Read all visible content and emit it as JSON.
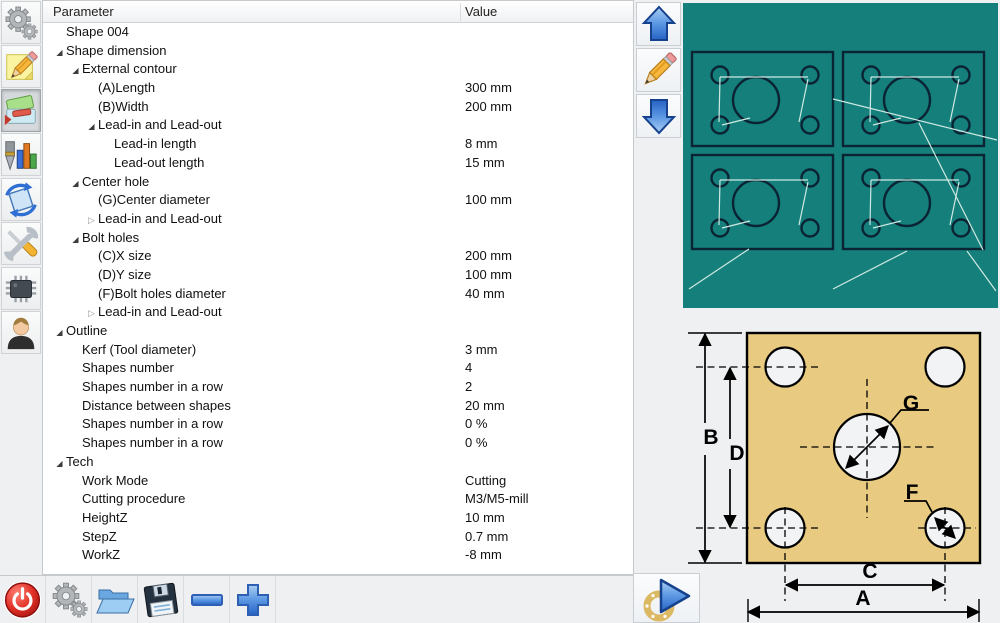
{
  "window": {
    "background": "#eef0f1",
    "accent_teal": "#15807b",
    "shape_outline_color": "#0a2434",
    "toolpath_color": "#cfe8e2",
    "plate_color": "#e8cb80"
  },
  "sidebar": {
    "items": [
      {
        "id": "settings",
        "icon": "gears-icon",
        "selected": false
      },
      {
        "id": "notes",
        "icon": "note-pencil-icon",
        "selected": false
      },
      {
        "id": "material",
        "icon": "material-icon",
        "selected": true
      },
      {
        "id": "tool-stats",
        "icon": "drill-chart-icon",
        "selected": false
      },
      {
        "id": "rotate",
        "icon": "rotate-icon",
        "selected": false
      },
      {
        "id": "tools",
        "icon": "wrench-screwdriver-icon",
        "selected": false
      },
      {
        "id": "hardware",
        "icon": "chip-icon",
        "selected": false
      },
      {
        "id": "user",
        "icon": "user-icon",
        "selected": false
      }
    ]
  },
  "table": {
    "columns": [
      "Parameter",
      "Value"
    ],
    "rows": [
      {
        "level": 0,
        "state": "none",
        "label": "Shape 004",
        "value": ""
      },
      {
        "level": 0,
        "state": "expanded",
        "label": "Shape dimension",
        "value": ""
      },
      {
        "level": 1,
        "state": "expanded",
        "label": "External contour",
        "value": ""
      },
      {
        "level": 2,
        "state": "none",
        "label": "(A)Length",
        "value": "300 mm"
      },
      {
        "level": 2,
        "state": "none",
        "label": "(B)Width",
        "value": "200 mm"
      },
      {
        "level": 2,
        "state": "expanded",
        "label": "Lead-in and Lead-out",
        "value": ""
      },
      {
        "level": 3,
        "state": "none",
        "label": "Lead-in length",
        "value": "8 mm"
      },
      {
        "level": 3,
        "state": "none",
        "label": "Lead-out length",
        "value": "15 mm"
      },
      {
        "level": 1,
        "state": "expanded",
        "label": "Center hole",
        "value": ""
      },
      {
        "level": 2,
        "state": "none",
        "label": "(G)Center diameter",
        "value": "100 mm"
      },
      {
        "level": 2,
        "state": "collapsed",
        "label": "Lead-in and Lead-out",
        "value": ""
      },
      {
        "level": 1,
        "state": "expanded",
        "label": "Bolt holes",
        "value": ""
      },
      {
        "level": 2,
        "state": "none",
        "label": "(C)X size",
        "value": "200 mm"
      },
      {
        "level": 2,
        "state": "none",
        "label": "(D)Y size",
        "value": "100 mm"
      },
      {
        "level": 2,
        "state": "none",
        "label": "(F)Bolt holes diameter",
        "value": "40 mm"
      },
      {
        "level": 2,
        "state": "collapsed",
        "label": "Lead-in and Lead-out",
        "value": ""
      },
      {
        "level": 0,
        "state": "expanded",
        "label": "Outline",
        "value": ""
      },
      {
        "level": 1,
        "state": "none",
        "label": "Kerf (Tool diameter)",
        "value": "3 mm"
      },
      {
        "level": 1,
        "state": "none",
        "label": "Shapes number",
        "value": "4"
      },
      {
        "level": 1,
        "state": "none",
        "label": "Shapes number in a row",
        "value": "2"
      },
      {
        "level": 1,
        "state": "none",
        "label": "Distance between shapes",
        "value": "20 mm"
      },
      {
        "level": 1,
        "state": "none",
        "label": "Shapes number in a row",
        "value": "0 %"
      },
      {
        "level": 1,
        "state": "none",
        "label": "Shapes number in a row",
        "value": "0 %"
      },
      {
        "level": 0,
        "state": "expanded",
        "label": "Tech",
        "value": ""
      },
      {
        "level": 1,
        "state": "none",
        "label": "Work Mode",
        "value": "Cutting"
      },
      {
        "level": 1,
        "state": "none",
        "label": "Cutting procedure",
        "value": "M3/M5-mill"
      },
      {
        "level": 1,
        "state": "none",
        "label": "HeightZ",
        "value": "10 mm"
      },
      {
        "level": 1,
        "state": "none",
        "label": "StepZ",
        "value": "0.7 mm"
      },
      {
        "level": 1,
        "state": "none",
        "label": "WorkZ",
        "value": "-8 mm"
      }
    ]
  },
  "nav": {
    "buttons": [
      {
        "id": "previous-shape",
        "icon": "arrow-up-icon"
      },
      {
        "id": "edit-shape",
        "icon": "pencil-icon"
      },
      {
        "id": "next-shape",
        "icon": "arrow-down-icon"
      }
    ]
  },
  "preview": {
    "shapes_count": 4,
    "grid_columns": 2,
    "grid_rows": 2,
    "holes_per_shape": 4,
    "center_holes_per_shape": 1
  },
  "diagram": {
    "labels": {
      "A": "A",
      "B": "B",
      "C": "C",
      "D": "D",
      "G": "G",
      "F": "F"
    }
  },
  "toolbar": {
    "buttons": [
      {
        "id": "power",
        "icon": "power-icon"
      },
      {
        "id": "settings",
        "icon": "gears-icon"
      },
      {
        "id": "open",
        "icon": "folder-open-icon"
      },
      {
        "id": "save",
        "icon": "floppy-icon"
      },
      {
        "id": "zoom-out",
        "icon": "minus-icon"
      },
      {
        "id": "zoom-in",
        "icon": "plus-icon"
      }
    ]
  },
  "run": {
    "id": "run",
    "icon": "play-icon"
  }
}
